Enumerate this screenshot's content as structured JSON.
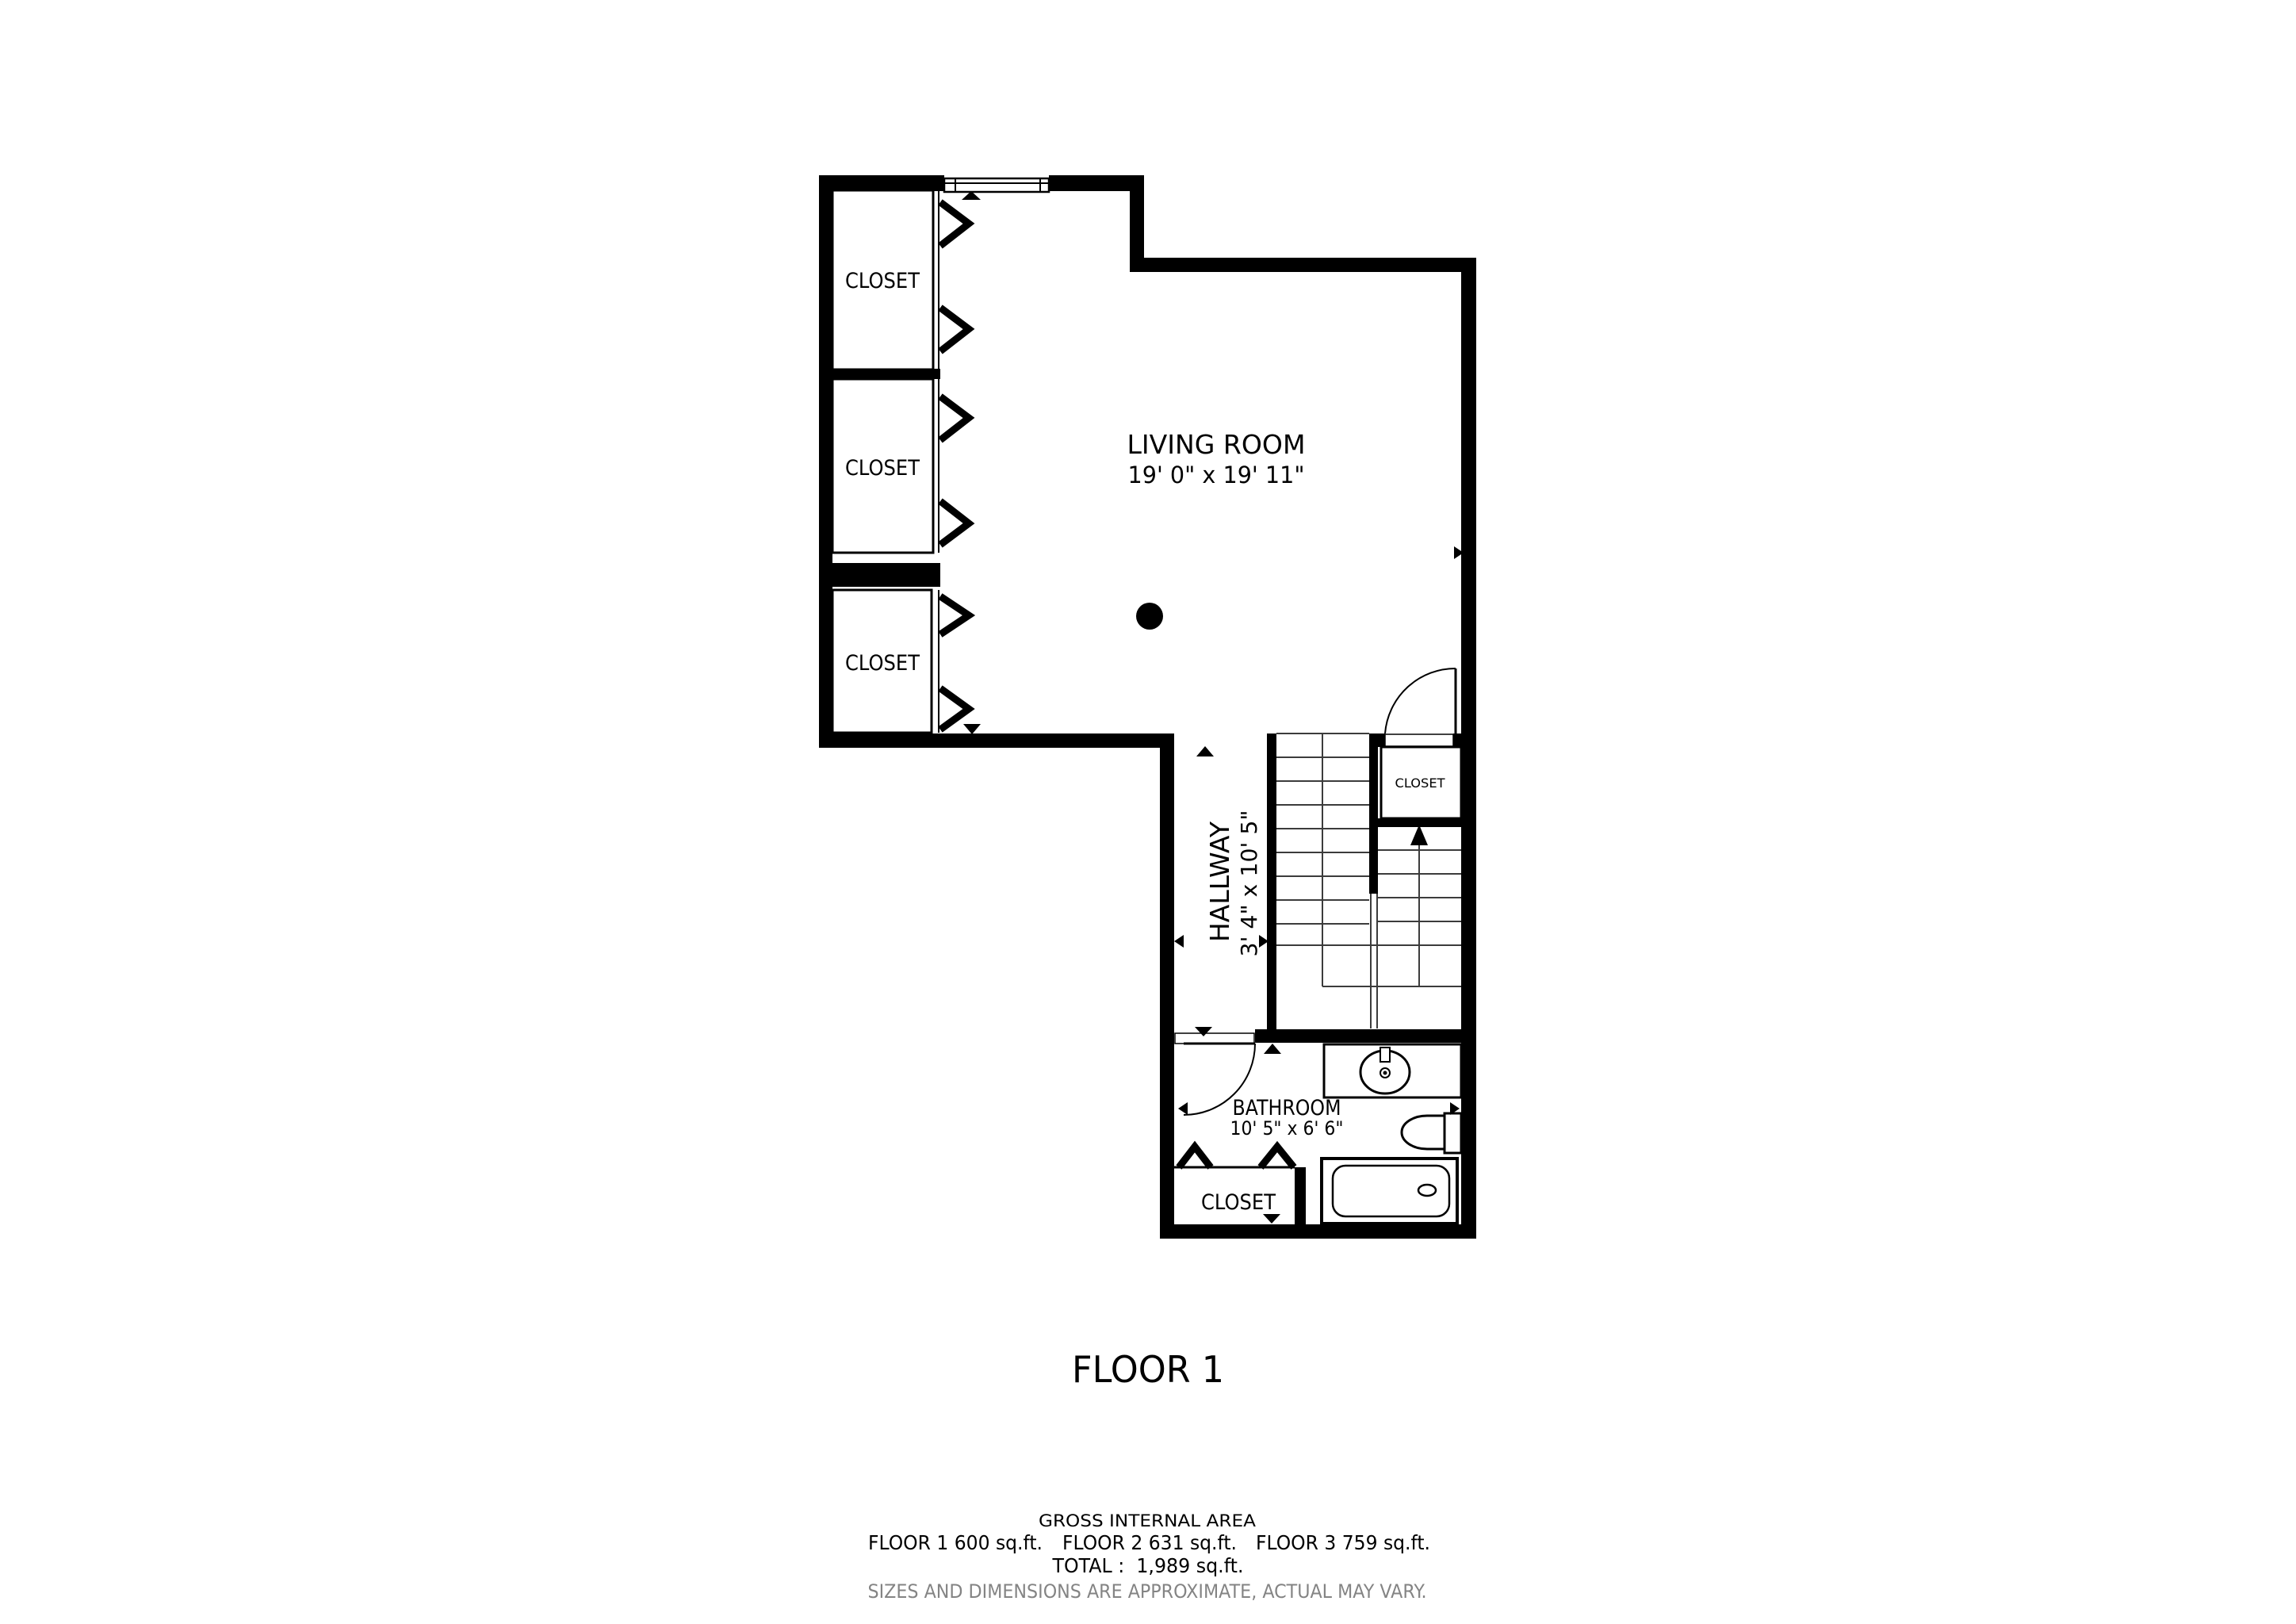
{
  "colors": {
    "ink": "#000000",
    "muted": "#848484",
    "background": "#ffffff"
  },
  "rooms": {
    "living_room": {
      "name": "LIVING ROOM",
      "dims": "19' 0\" x 19' 11\""
    },
    "hallway": {
      "name": "HALLWAY",
      "dims": "3' 4\" x 10' 5\""
    },
    "bathroom": {
      "name": "BATHROOM",
      "dims": "10' 5\" x 6' 6\""
    },
    "closet_top": {
      "name": "CLOSET"
    },
    "closet_middle": {
      "name": "CLOSET"
    },
    "closet_lower": {
      "name": "CLOSET"
    },
    "closet_stairs": {
      "name": "CLOSET"
    },
    "closet_bathroom": {
      "name": "CLOSET"
    }
  },
  "floor_label": "FLOOR 1",
  "footer": {
    "title": "GROSS INTERNAL AREA",
    "floor_areas": [
      "FLOOR 1 600 sq.ft.",
      "FLOOR 2 631 sq.ft.",
      "FLOOR 3 759 sq.ft."
    ],
    "total": "TOTAL :  1,989 sq.ft.",
    "disclaimer": "SIZES AND DIMENSIONS ARE APPROXIMATE, ACTUAL MAY VARY."
  }
}
